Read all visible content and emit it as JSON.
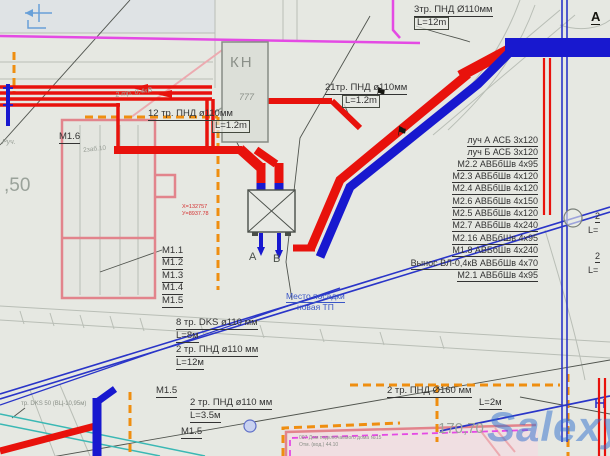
{
  "colors": {
    "bg": "#e6e8e2",
    "red": "#e8120c",
    "blue": "#1818cf",
    "thinblue": "#2a35c8",
    "magenta": "#e44ae4",
    "orange": "#ef8e10",
    "pink": "#e2848c",
    "pinklight": "#ecaab0",
    "cyan": "#3ab8b4",
    "grayline": "#b9beb6",
    "darkline": "#50544e",
    "lightblue": "#68a0d8",
    "watermark": "rgba(45,110,205,0.5)"
  },
  "watermark_text": "Salexy",
  "survey_flag_glyph": "⚑",
  "labels": [
    {
      "id": "pipe3-top-label",
      "text": "3тр.  ПНД Ø110мм",
      "x": 414,
      "y": 5,
      "fs": 9.5,
      "u": 1
    },
    {
      "id": "pipe3-top-length",
      "text": "L=12m",
      "x": 414,
      "y": 17,
      "fs": 9.5,
      "box": 1
    },
    {
      "id": "pipe21-label",
      "text": "21тр. ПНД ø110мм",
      "x": 325,
      "y": 83,
      "fs": 9.5,
      "u": 1
    },
    {
      "id": "pipe21-length",
      "text": "L=1.2m",
      "x": 342,
      "y": 95,
      "fs": 9.5,
      "box": 1
    },
    {
      "id": "pipe12-label",
      "text": "12 тр. ПНД ø110мм",
      "x": 148,
      "y": 109,
      "fs": 9.5,
      "u": 1
    },
    {
      "id": "pipe12-length",
      "text": "L=1.2m",
      "x": 212,
      "y": 120,
      "fs": 9.5,
      "box": 1
    },
    {
      "id": "cable04-note",
      "text": "2 тр. 0,4кВ",
      "x": 115,
      "y": 92,
      "fs": 7,
      "color": "#9aa098",
      "rot": -8,
      "i": 1
    },
    {
      "id": "kn-title",
      "text": "КН",
      "x": 230,
      "y": 55,
      "fs": 15,
      "color": "#8b9089",
      "ls": 2
    },
    {
      "id": "kn-symbol",
      "text": "777",
      "x": 239,
      "y": 93,
      "fs": 9,
      "color": "#8b9089",
      "i": 1
    },
    {
      "id": "cable-row-luch-a",
      "text": "луч А АСБ 3х120",
      "r": 72,
      "y": 136,
      "fs": 9,
      "u": 1
    },
    {
      "id": "cable-row-luch-b",
      "text": "луч Б АСБ 3х120",
      "r": 72,
      "y": 148,
      "fs": 9,
      "u": 1
    },
    {
      "id": "cable-row-m2-2",
      "text": "М2.2 АВБбШв 4х95",
      "r": 72,
      "y": 160,
      "fs": 9,
      "u": 1
    },
    {
      "id": "cable-row-m2-3",
      "text": "М2.3 АВБбШв 4х120",
      "r": 72,
      "y": 172,
      "fs": 9,
      "u": 1
    },
    {
      "id": "cable-row-m2-4",
      "text": "М2.4 АВБбШв 4х120",
      "r": 72,
      "y": 184,
      "fs": 9,
      "u": 1
    },
    {
      "id": "cable-row-m2-6",
      "text": "М2.6 АВБбШв 4х150",
      "r": 72,
      "y": 197,
      "fs": 9,
      "u": 1
    },
    {
      "id": "cable-row-m2-5",
      "text": "М2.5 АВБбШв 4х120",
      "r": 72,
      "y": 209,
      "fs": 9,
      "u": 1
    },
    {
      "id": "cable-row-m2-7",
      "text": "М2.7 АВБбШв 4х240",
      "r": 72,
      "y": 221,
      "fs": 9,
      "u": 1
    },
    {
      "id": "cable-row-m2-16",
      "text": "М2.16 АВБбШв 4х95",
      "r": 72,
      "y": 234,
      "fs": 9,
      "u": 1
    },
    {
      "id": "cable-row-m1-8",
      "text": "М1.8 АВБбШв 4х240",
      "r": 72,
      "y": 246,
      "fs": 9,
      "u": 1
    },
    {
      "id": "cable-row-vynos",
      "text": "Вынос ВЛ-0,4кВ АВБбШв 4х70",
      "r": 72,
      "y": 259,
      "fs": 9,
      "u": 1
    },
    {
      "id": "cable-row-m2-1",
      "text": "М2.1 АВБбШв 4х95",
      "r": 72,
      "y": 271,
      "fs": 9,
      "u": 1
    },
    {
      "id": "m1-list-1",
      "text": "М1.1",
      "x": 162,
      "y": 246,
      "fs": 9.5,
      "u": 1
    },
    {
      "id": "m1-list-2",
      "text": "М1.2",
      "x": 162,
      "y": 258,
      "fs": 9.5,
      "u": 1
    },
    {
      "id": "m1-list-3",
      "text": "М1.3",
      "x": 162,
      "y": 271,
      "fs": 9.5,
      "u": 1
    },
    {
      "id": "m1-list-4",
      "text": "М1.4",
      "x": 162,
      "y": 283,
      "fs": 9.5,
      "u": 1
    },
    {
      "id": "m1-list-5",
      "text": "М1.5",
      "x": 162,
      "y": 296,
      "fs": 9.5,
      "u": 1
    },
    {
      "id": "m1-6-label",
      "text": "М1.6",
      "x": 59,
      "y": 132,
      "fs": 9.5,
      "u": 1
    },
    {
      "id": "tp-outlet-a",
      "text": "А",
      "x": 249,
      "y": 252,
      "fs": 11,
      "color": "#4a4f49"
    },
    {
      "id": "tp-outlet-b",
      "text": "В",
      "x": 273,
      "y": 254,
      "fs": 11,
      "color": "#4a4f49"
    },
    {
      "id": "tp-site-line1",
      "text": "Место посадки",
      "x": 286,
      "y": 292,
      "fs": 8.5,
      "color": "#3a56c6",
      "u": 1
    },
    {
      "id": "tp-site-line2",
      "text": "новая ТП",
      "x": 297,
      "y": 303,
      "fs": 8.5,
      "color": "#3a56c6"
    },
    {
      "id": "pipe8-label",
      "text": "8 тр. DKS ø110 мм",
      "x": 176,
      "y": 318,
      "fs": 9.5,
      "u": 1
    },
    {
      "id": "pipe8-length",
      "text": "L=8м",
      "x": 176,
      "y": 331,
      "fs": 9.5,
      "u": 1
    },
    {
      "id": "pipe2-12-label",
      "text": "2 тр. ПНД ø110 мм",
      "x": 176,
      "y": 345,
      "fs": 9.5,
      "u": 1
    },
    {
      "id": "pipe2-12-length",
      "text": "L=12м",
      "x": 176,
      "y": 358,
      "fs": 9.5,
      "u": 1
    },
    {
      "id": "m1-5-left",
      "text": "М1.5",
      "x": 156,
      "y": 386,
      "fs": 9.5,
      "u": 1
    },
    {
      "id": "pipe2-35-label",
      "text": "2 тр. ПНД ø110 мм",
      "x": 190,
      "y": 398,
      "fs": 9.5,
      "u": 1
    },
    {
      "id": "pipe2-35-length",
      "text": "L=3.5м",
      "x": 190,
      "y": 411,
      "fs": 9.5,
      "u": 1
    },
    {
      "id": "m1-5-lower",
      "text": "М1.5",
      "x": 181,
      "y": 427,
      "fs": 9.5,
      "u": 1
    },
    {
      "id": "pipe160-label",
      "text": "2 тр. ПНД Ø160 мм",
      "x": 387,
      "y": 386,
      "fs": 9.5,
      "u": 1
    },
    {
      "id": "pipe160-length",
      "text": "L=2м",
      "x": 479,
      "y": 398,
      "fs": 9.5,
      "u": 1
    },
    {
      "id": "elevation-170",
      "text": "170,70",
      "x": 438,
      "y": 421,
      "fs": 15,
      "color": "#9aa29a"
    },
    {
      "id": "elevation-50",
      "text": ",50",
      "x": 4,
      "y": 176,
      "fs": 19,
      "color": "#9aa29a"
    },
    {
      "id": "note-zab",
      "text": "2заб.10",
      "x": 83,
      "y": 148,
      "fs": 6.5,
      "color": "#9aa098",
      "rot": -6
    },
    {
      "id": "note-ruch",
      "text": "Руч.",
      "x": 2,
      "y": 139,
      "fs": 7,
      "color": "#9aa098",
      "i": 1
    },
    {
      "id": "note-dks",
      "text": "тр. DKS 50 (ВЦ-10,95м)",
      "x": 21,
      "y": 401,
      "fs": 6,
      "color": "#8a9088"
    },
    {
      "id": "bldg-note-1",
      "text": "007 Дом подключаемого дома №15",
      "x": 299,
      "y": 436,
      "fs": 5,
      "color": "#8a9088"
    },
    {
      "id": "bldg-note-2",
      "text": "Отм. (вод.) 44.10",
      "x": 299,
      "y": 443,
      "fs": 5,
      "color": "#8a9088"
    },
    {
      "id": "coord-x",
      "text": "Х=132757",
      "x": 182,
      "y": 205,
      "fs": 5.5,
      "color": "#d43030"
    },
    {
      "id": "coord-y",
      "text": "У=8937.78",
      "x": 182,
      "y": 212,
      "fs": 5.5,
      "color": "#d43030"
    },
    {
      "id": "edge-label-2a",
      "text": "2",
      "x": 595,
      "y": 212,
      "fs": 9,
      "u": 1
    },
    {
      "id": "edge-label-la",
      "text": "L=",
      "x": 588,
      "y": 226,
      "fs": 9
    },
    {
      "id": "edge-label-2b",
      "text": "2",
      "x": 595,
      "y": 252,
      "fs": 9,
      "u": 1
    },
    {
      "id": "edge-label-lb",
      "text": "L=",
      "x": 588,
      "y": 266,
      "fs": 9
    },
    {
      "id": "flag-a-top-right",
      "text": "А",
      "x": 591,
      "y": 10,
      "fs": 13,
      "b": 1,
      "u": 1,
      "color": "#15150f"
    }
  ]
}
